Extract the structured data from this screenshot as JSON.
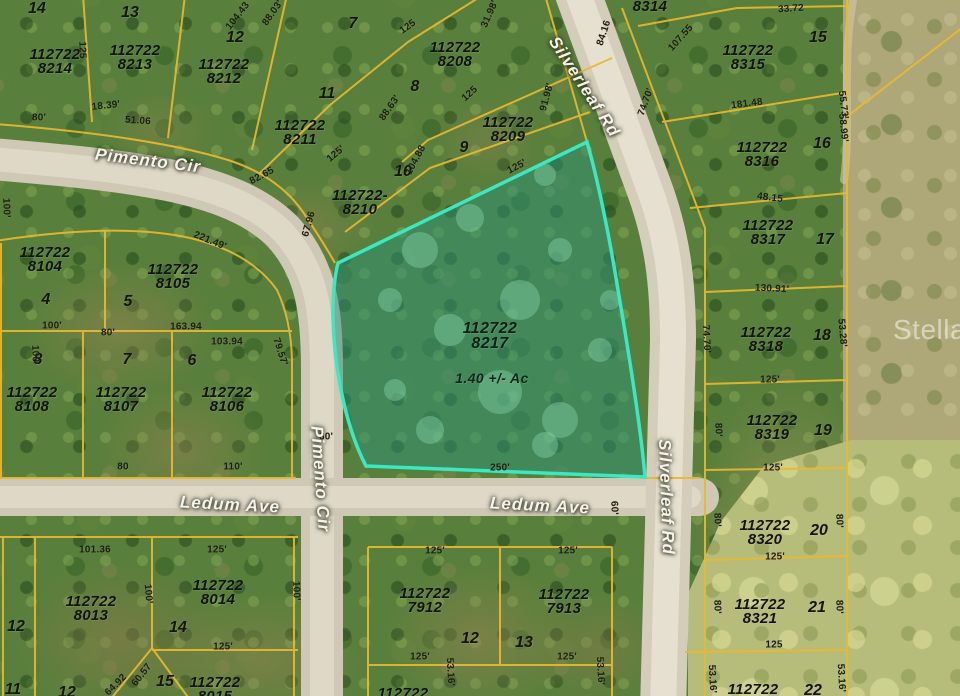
{
  "title": "Aerial parcel map photo",
  "watermark": "Stellar",
  "highlighted": {
    "apn_line1": "112722",
    "apn_line2": "8217",
    "area_label": "1.40 +/- Ac"
  },
  "colors": {
    "parcel_line": "#e9b92f",
    "highlight_stroke": "#3ae8c4",
    "highlight_fill": "rgba(72,216,188,0.25)",
    "road": "#d2cbb8",
    "street_text": "#f6f4ea",
    "label_text": "#12130a"
  },
  "streets": [
    {
      "name": "Pimento Cir",
      "x": 148,
      "y": 161,
      "rot": 7
    },
    {
      "name": "Pimento Cir",
      "x": 320,
      "y": 479,
      "rot": 86
    },
    {
      "name": "Silverleaf Rd",
      "x": 584,
      "y": 87,
      "rot": 57
    },
    {
      "name": "Silverleaf Rd",
      "x": 666,
      "y": 497,
      "rot": 88
    },
    {
      "name": "Ledum Ave",
      "x": 230,
      "y": 505,
      "rot": 3
    },
    {
      "name": "Ledum Ave",
      "x": 540,
      "y": 506,
      "rot": 3
    }
  ],
  "parcels": [
    {
      "line1": "112722",
      "line2": "8214",
      "x": 55,
      "y": 62
    },
    {
      "line1": "112722",
      "line2": "8213",
      "x": 135,
      "y": 58
    },
    {
      "line1": "112722",
      "line2": "8212",
      "x": 224,
      "y": 72
    },
    {
      "line1": "112722",
      "line2": "8211",
      "x": 300,
      "y": 133
    },
    {
      "line1": "112722",
      "line2": "8208",
      "x": 455,
      "y": 55
    },
    {
      "line1": "112722",
      "line2": "8209",
      "x": 508,
      "y": 130
    },
    {
      "line1": "112722-",
      "line2": "8210",
      "x": 360,
      "y": 203
    },
    {
      "line1": "8314",
      "line2": "",
      "x": 650,
      "y": 7
    },
    {
      "line1": "112722",
      "line2": "8315",
      "x": 748,
      "y": 58
    },
    {
      "line1": "112722",
      "line2": "8316",
      "x": 762,
      "y": 155
    },
    {
      "line1": "112722",
      "line2": "8317",
      "x": 768,
      "y": 233
    },
    {
      "line1": "112722",
      "line2": "8318",
      "x": 766,
      "y": 340
    },
    {
      "line1": "112722",
      "line2": "8319",
      "x": 772,
      "y": 428
    },
    {
      "line1": "112722",
      "line2": "8320",
      "x": 765,
      "y": 533
    },
    {
      "line1": "112722",
      "line2": "8321",
      "x": 760,
      "y": 612
    },
    {
      "line1": "112722",
      "line2": "",
      "x": 753,
      "y": 690
    },
    {
      "line1": "112722",
      "line2": "8104",
      "x": 45,
      "y": 260
    },
    {
      "line1": "112722",
      "line2": "8105",
      "x": 173,
      "y": 277
    },
    {
      "line1": "112722",
      "line2": "8108",
      "x": 32,
      "y": 400
    },
    {
      "line1": "112722",
      "line2": "8107",
      "x": 121,
      "y": 400
    },
    {
      "line1": "112722",
      "line2": "8106",
      "x": 227,
      "y": 400
    },
    {
      "line1": "112722",
      "line2": "8013",
      "x": 91,
      "y": 609
    },
    {
      "line1": "112722",
      "line2": "8014",
      "x": 218,
      "y": 593
    },
    {
      "line1": "112722",
      "line2": "8015",
      "x": 215,
      "y": 690
    },
    {
      "line1": "112722",
      "line2": "7912",
      "x": 425,
      "y": 601
    },
    {
      "line1": "112722",
      "line2": "7913",
      "x": 564,
      "y": 602
    },
    {
      "line1": "112722",
      "line2": "",
      "x": 403,
      "y": 694
    }
  ],
  "lots": [
    {
      "n": "14",
      "x": 37,
      "y": 9
    },
    {
      "n": "13",
      "x": 130,
      "y": 13
    },
    {
      "n": "12",
      "x": 235,
      "y": 38
    },
    {
      "n": "11",
      "x": 327,
      "y": 94
    },
    {
      "n": "7",
      "x": 353,
      "y": 24
    },
    {
      "n": "8",
      "x": 415,
      "y": 87
    },
    {
      "n": "9",
      "x": 464,
      "y": 148
    },
    {
      "n": "10",
      "x": 403,
      "y": 172
    },
    {
      "n": "15",
      "x": 818,
      "y": 38
    },
    {
      "n": "16",
      "x": 822,
      "y": 144
    },
    {
      "n": "17",
      "x": 825,
      "y": 240
    },
    {
      "n": "18",
      "x": 822,
      "y": 336
    },
    {
      "n": "19",
      "x": 823,
      "y": 431
    },
    {
      "n": "20",
      "x": 819,
      "y": 531
    },
    {
      "n": "21",
      "x": 817,
      "y": 608
    },
    {
      "n": "22",
      "x": 813,
      "y": 691
    },
    {
      "n": "4",
      "x": 46,
      "y": 300
    },
    {
      "n": "5",
      "x": 128,
      "y": 302
    },
    {
      "n": "8",
      "x": 38,
      "y": 360
    },
    {
      "n": "7",
      "x": 127,
      "y": 360
    },
    {
      "n": "6",
      "x": 192,
      "y": 361
    },
    {
      "n": "12",
      "x": 16,
      "y": 627
    },
    {
      "n": "14",
      "x": 178,
      "y": 628
    },
    {
      "n": "15",
      "x": 165,
      "y": 682
    },
    {
      "n": "11",
      "x": 13,
      "y": 690
    },
    {
      "n": "12",
      "x": 67,
      "y": 693
    },
    {
      "n": "12",
      "x": 470,
      "y": 639
    },
    {
      "n": "13",
      "x": 524,
      "y": 643
    }
  ],
  "measurements": [
    {
      "t": "80'",
      "x": 39,
      "y": 118,
      "r": 0
    },
    {
      "t": "18.39'",
      "x": 106,
      "y": 106,
      "r": -6
    },
    {
      "t": "51.06",
      "x": 138,
      "y": 121,
      "r": 4
    },
    {
      "t": "125",
      "x": 82,
      "y": 50,
      "r": 88
    },
    {
      "t": "104.43",
      "x": 238,
      "y": 16,
      "r": -52
    },
    {
      "t": "88.03'",
      "x": 273,
      "y": 13,
      "r": -55
    },
    {
      "t": "125",
      "x": 408,
      "y": 27,
      "r": -35
    },
    {
      "t": "31.98'",
      "x": 490,
      "y": 14,
      "r": -66
    },
    {
      "t": "84.16",
      "x": 604,
      "y": 33,
      "r": -72
    },
    {
      "t": "33.72",
      "x": 791,
      "y": 9,
      "r": -4
    },
    {
      "t": "107.55",
      "x": 681,
      "y": 38,
      "r": -48
    },
    {
      "t": "55.73'",
      "x": 843,
      "y": 105,
      "r": 83
    },
    {
      "t": "88.63'",
      "x": 390,
      "y": 108,
      "r": -55
    },
    {
      "t": "125'",
      "x": 336,
      "y": 154,
      "r": -40
    },
    {
      "t": "104.88",
      "x": 416,
      "y": 160,
      "r": -62
    },
    {
      "t": "82.65",
      "x": 262,
      "y": 176,
      "r": -28
    },
    {
      "t": "67.96",
      "x": 309,
      "y": 224,
      "r": -74
    },
    {
      "t": "91.98'",
      "x": 547,
      "y": 97,
      "r": -75
    },
    {
      "t": "125",
      "x": 470,
      "y": 94,
      "r": -42
    },
    {
      "t": "125'",
      "x": 517,
      "y": 167,
      "r": -28
    },
    {
      "t": "221.49'",
      "x": 210,
      "y": 241,
      "r": 22
    },
    {
      "t": "181.48",
      "x": 747,
      "y": 104,
      "r": -7
    },
    {
      "t": "74.70'",
      "x": 646,
      "y": 102,
      "r": -70
    },
    {
      "t": "58.99'",
      "x": 843,
      "y": 128,
      "r": 84
    },
    {
      "t": "48.15",
      "x": 770,
      "y": 198,
      "r": 7
    },
    {
      "t": "130.91'",
      "x": 772,
      "y": 289,
      "r": 3
    },
    {
      "t": "74.70'",
      "x": 706,
      "y": 339,
      "r": 87
    },
    {
      "t": "53.28'",
      "x": 842,
      "y": 333,
      "r": 85
    },
    {
      "t": "125'",
      "x": 770,
      "y": 380,
      "r": 0
    },
    {
      "t": "80'",
      "x": 718,
      "y": 430,
      "r": 88
    },
    {
      "t": "125'",
      "x": 773,
      "y": 468,
      "r": 0
    },
    {
      "t": "80'",
      "x": 717,
      "y": 520,
      "r": 88
    },
    {
      "t": "80'",
      "x": 839,
      "y": 521,
      "r": 88
    },
    {
      "t": "125'",
      "x": 775,
      "y": 557,
      "r": 0
    },
    {
      "t": "80'",
      "x": 717,
      "y": 607,
      "r": 88
    },
    {
      "t": "80'",
      "x": 839,
      "y": 607,
      "r": 88
    },
    {
      "t": "125",
      "x": 774,
      "y": 645,
      "r": 0
    },
    {
      "t": "53.16'",
      "x": 712,
      "y": 679,
      "r": 87
    },
    {
      "t": "53.16'",
      "x": 841,
      "y": 678,
      "r": 87
    },
    {
      "t": "100'",
      "x": 6,
      "y": 208,
      "r": 88
    },
    {
      "t": "100'",
      "x": 35,
      "y": 355,
      "r": 88
    },
    {
      "t": "100'",
      "x": 52,
      "y": 326,
      "r": 0
    },
    {
      "t": "80'",
      "x": 108,
      "y": 333,
      "r": 0
    },
    {
      "t": "163.94",
      "x": 186,
      "y": 327,
      "r": 0
    },
    {
      "t": "103.94",
      "x": 227,
      "y": 342,
      "r": 0
    },
    {
      "t": "79.57'",
      "x": 280,
      "y": 352,
      "r": 72
    },
    {
      "t": "80",
      "x": 123,
      "y": 467,
      "r": 0
    },
    {
      "t": "110'",
      "x": 233,
      "y": 467,
      "r": 0
    },
    {
      "t": "100'",
      "x": 296,
      "y": 591,
      "r": 88
    },
    {
      "t": "100'",
      "x": 148,
      "y": 594,
      "r": 85
    },
    {
      "t": "101.36",
      "x": 95,
      "y": 550,
      "r": 0
    },
    {
      "t": "125'",
      "x": 217,
      "y": 550,
      "r": 0
    },
    {
      "t": "125'",
      "x": 223,
      "y": 647,
      "r": 0
    },
    {
      "t": "64.92",
      "x": 116,
      "y": 685,
      "r": -45
    },
    {
      "t": "60.57",
      "x": 142,
      "y": 675,
      "r": -52
    },
    {
      "t": "250'",
      "x": 500,
      "y": 468,
      "r": 0
    },
    {
      "t": "60'",
      "x": 326,
      "y": 437,
      "r": 0
    },
    {
      "t": "60'",
      "x": 614,
      "y": 508,
      "r": 88
    },
    {
      "t": "125'",
      "x": 435,
      "y": 551,
      "r": 0
    },
    {
      "t": "125'",
      "x": 568,
      "y": 551,
      "r": 0
    },
    {
      "t": "125'",
      "x": 420,
      "y": 657,
      "r": 0
    },
    {
      "t": "125'",
      "x": 567,
      "y": 657,
      "r": 0
    },
    {
      "t": "53.16'",
      "x": 450,
      "y": 672,
      "r": 87
    },
    {
      "t": "53.16'",
      "x": 600,
      "y": 671,
      "r": 87
    }
  ]
}
